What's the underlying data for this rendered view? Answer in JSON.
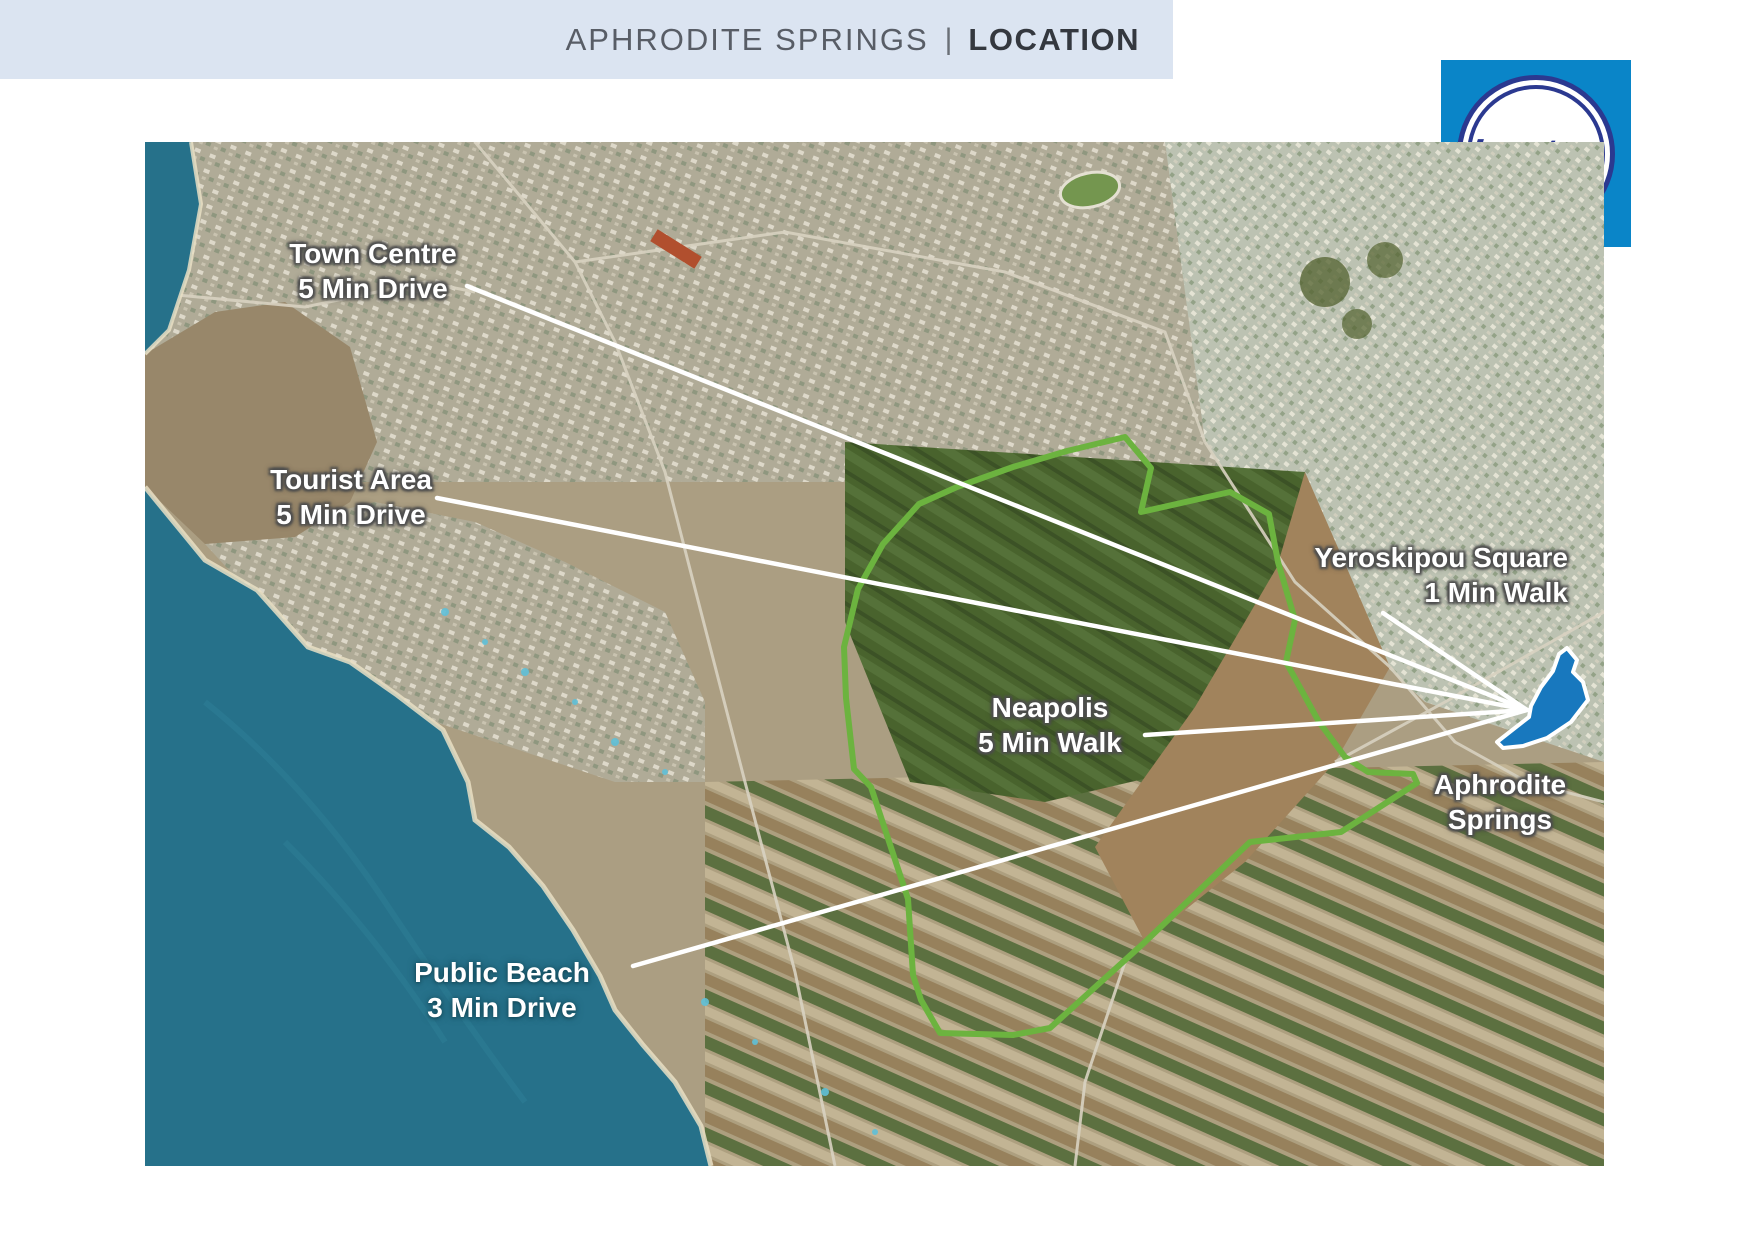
{
  "header": {
    "title_primary": "APHRODITE SPRINGS",
    "divider": "|",
    "title_secondary": "LOCATION"
  },
  "logo": {
    "brand": "Leptos"
  },
  "map": {
    "labels": [
      {
        "id": "town-centre",
        "line1": "Town Centre",
        "line2": "5 Min Drive"
      },
      {
        "id": "tourist-area",
        "line1": "Tourist Area",
        "line2": "5 Min Drive"
      },
      {
        "id": "yeroskipou-square",
        "line1": "Yeroskipou Square",
        "line2": "1 Min Walk"
      },
      {
        "id": "neapolis",
        "line1": "Neapolis",
        "line2": "5 Min Walk"
      },
      {
        "id": "aphrodite-springs",
        "line1": "Aphrodite",
        "line2": "Springs"
      },
      {
        "id": "public-beach",
        "line1": "Public Beach",
        "line2": "3 Min Drive"
      }
    ]
  },
  "colors": {
    "banner_bg": "#dbe4f1",
    "title_primary": "#585d66",
    "title_secondary": "#34383f",
    "logo_blue": "#0a85c8",
    "logo_navy": "#2b3990",
    "site_outline_green": "#6cb33f",
    "site_marker_blue": "#1878be",
    "callout_white": "#ffffff",
    "sea_teal": "#26718a"
  }
}
